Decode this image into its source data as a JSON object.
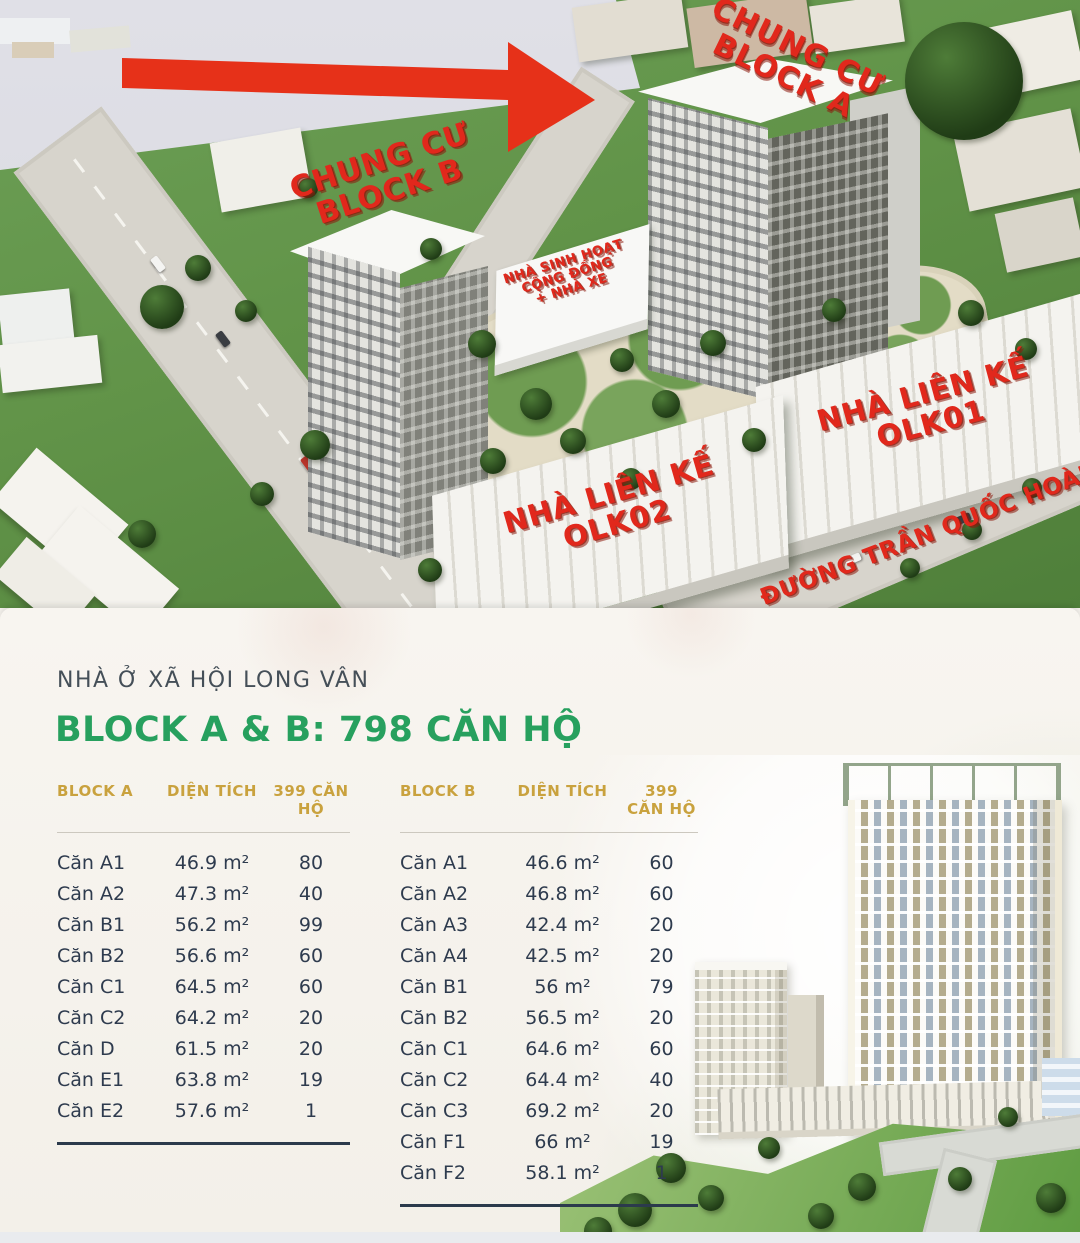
{
  "site_plan": {
    "labels": {
      "block_a": [
        "CHUNG CƯ",
        "BLOCK A"
      ],
      "block_b": [
        "CHUNG CƯ",
        "BLOCK B"
      ],
      "community_house": [
        "NHÀ SINH HOẠT",
        "CỘNG ĐỒNG",
        "+ NHÀ XE"
      ],
      "olk01": [
        "NHÀ LIÊN KẾ",
        "OLK01"
      ],
      "olk02": [
        "NHÀ LIÊN KẾ",
        "OLK02"
      ],
      "street": "ĐƯỜNG TRẦN QUỐC HOÀN"
    }
  },
  "info_panel": {
    "subtitle": "NHÀ Ở XÃ HỘI LONG VÂN",
    "title": "BLOCK A & B: 798 CĂN HỘ",
    "table_a": {
      "headers": [
        "BLOCK A",
        "DIỆN TÍCH",
        "399 CĂN HỘ"
      ],
      "rows": [
        [
          "Căn A1",
          "46.9 m²",
          "80"
        ],
        [
          "Căn A2",
          "47.3 m²",
          "40"
        ],
        [
          "Căn B1",
          "56.2 m²",
          "99"
        ],
        [
          "Căn B2",
          "56.6 m²",
          "60"
        ],
        [
          "Căn C1",
          "64.5 m²",
          "60"
        ],
        [
          "Căn C2",
          "64.2 m²",
          "20"
        ],
        [
          "Căn D",
          "61.5 m²",
          "20"
        ],
        [
          "Căn E1",
          "63.8 m²",
          "19"
        ],
        [
          "Căn E2",
          "57.6 m²",
          "1"
        ]
      ]
    },
    "table_b": {
      "headers": [
        "BLOCK B",
        "DIỆN TÍCH",
        "399 CĂN HỘ"
      ],
      "rows": [
        [
          "Căn A1",
          "46.6 m²",
          "60"
        ],
        [
          "Căn A2",
          "46.8 m²",
          "60"
        ],
        [
          "Căn A3",
          "42.4 m²",
          "20"
        ],
        [
          "Căn A4",
          "42.5 m²",
          "20"
        ],
        [
          "Căn B1",
          "56 m²",
          "79"
        ],
        [
          "Căn B2",
          "56.5 m²",
          "20"
        ],
        [
          "Căn C1",
          "64.6 m²",
          "60"
        ],
        [
          "Căn C2",
          "64.4 m²",
          "40"
        ],
        [
          "Căn C3",
          "69.2 m²",
          "20"
        ],
        [
          "Căn F1",
          "66 m²",
          "19"
        ],
        [
          "Căn F2",
          "58.1 m²",
          "1"
        ]
      ]
    }
  },
  "colors": {
    "label_red": "#e1281c",
    "arrow_red": "#e63119",
    "title_green": "#27a05e",
    "header_gold": "#c9a23e",
    "table_navy": "#2e3b4e"
  }
}
